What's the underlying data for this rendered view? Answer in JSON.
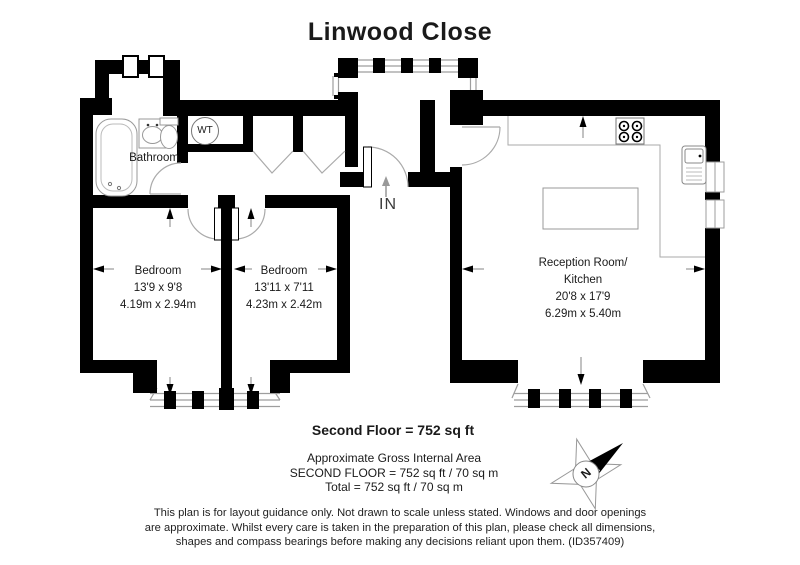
{
  "title": "Linwood Close",
  "plan": {
    "bathroom": {
      "label": "Bathroom"
    },
    "water_tank": {
      "label": "WT"
    },
    "entrance": {
      "label": "IN"
    },
    "bedroom1": {
      "name": "Bedroom",
      "size_imperial": "13'9 x 9'8",
      "size_metric": "4.19m x 2.94m"
    },
    "bedroom2": {
      "name": "Bedroom",
      "size_imperial": "13'11 x 7'11",
      "size_metric": "4.23m x 2.42m"
    },
    "reception": {
      "name_line1": "Reception Room/",
      "name_line2": "Kitchen",
      "size_imperial": "20'8 x 17'9",
      "size_metric": "6.29m x 5.40m"
    },
    "compass": {
      "north_label": "N"
    }
  },
  "summary": {
    "floor_line": "Second Floor = 752 sq ft",
    "area_heading": "Approximate Gross Internal Area",
    "area_line1": "SECOND FLOOR = 752 sq ft / 70 sq m",
    "area_line2": "Total = 752 sq ft / 70 sq m"
  },
  "disclaimer": {
    "line1": "This plan is for layout guidance only. Not drawn to scale unless stated. Windows and door openings",
    "line2": "are approximate. Whilst every care is taken in the preparation of this plan, please check all dimensions,",
    "line3": "shapes and compass bearings before making any decisions reliant upon them. (ID357409)"
  },
  "colors": {
    "walls": "#000000",
    "thin_lines": "#9e9e9e",
    "text": "#1a1a1a"
  }
}
